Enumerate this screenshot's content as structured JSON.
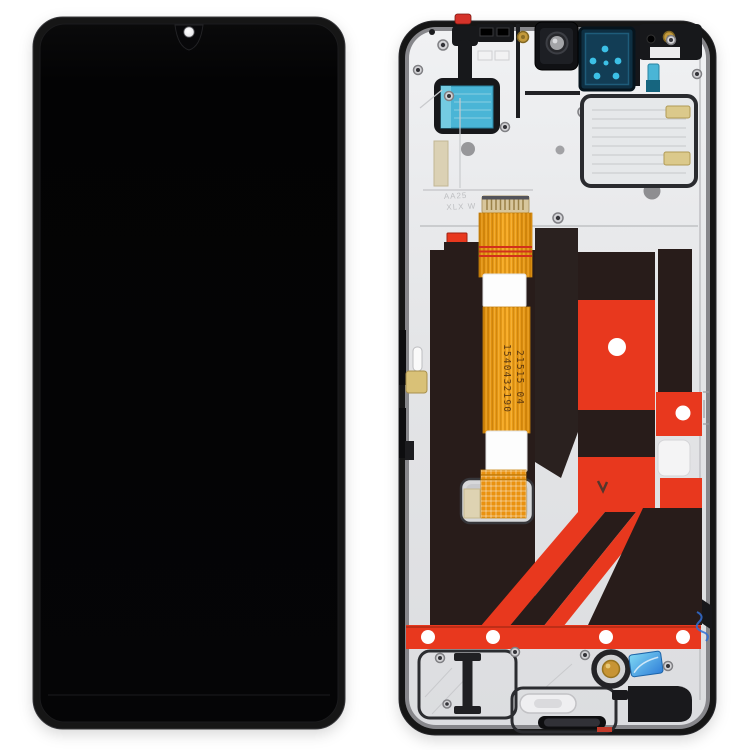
{
  "image": {
    "kind": "product-photo",
    "subject": "Phone LCD screen and digitizer full assembly with frame — front view (left) and back view (right)",
    "background": "#ffffff"
  },
  "front_view": {
    "notch": "teardrop",
    "camera_dot": "white"
  },
  "back_view": {
    "flex_cable": {
      "serial_line_1": "1540432190",
      "serial_line_2": "21515  04",
      "connector_label": "AA07-1W"
    },
    "plate_markings": {
      "line_1": "AA25",
      "line_2": "XLX W"
    }
  },
  "colors": {
    "bg": "#ffffff",
    "frame_black": "#121214",
    "screen_black": "#040405",
    "plate_silver": "#e9eaec",
    "plate_shade": "#d9dadc",
    "adhesive_brown": "#281c1a",
    "adhesive_red": "#e8381e",
    "cable_orange": "#f0960e",
    "pad_cyan": "#4ab5d6",
    "sticker_teal": "#123d55",
    "dot_cyan": "#3cc0e6",
    "gold": "#c49a3c",
    "cream": "#dbc98b",
    "ring_gold": "#c79434",
    "holo_blue": "#2f7ed8",
    "red_tab": "#d5332a"
  }
}
